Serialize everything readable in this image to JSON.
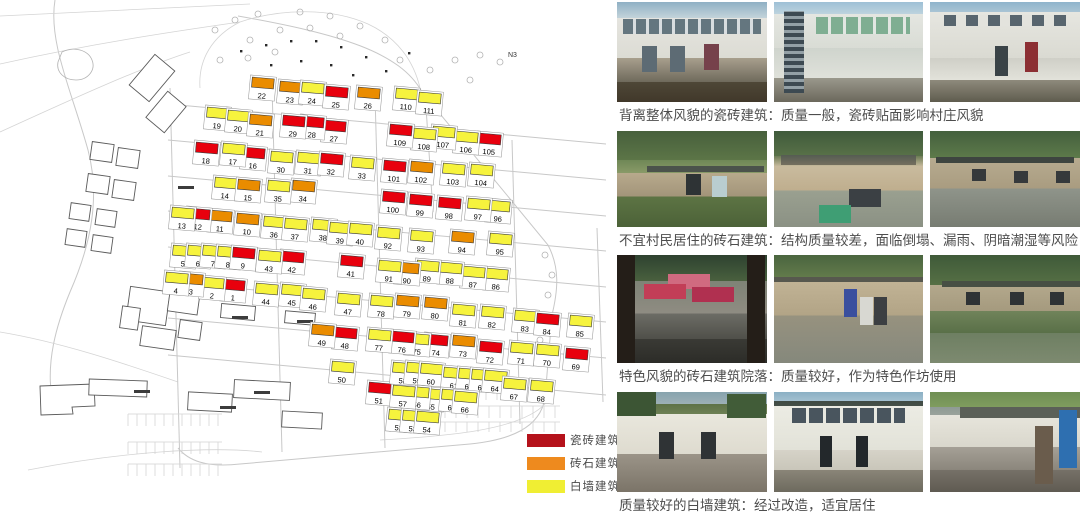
{
  "map": {
    "area_label": "N3",
    "building_colors": {
      "R": "#e8000d",
      "O": "#ea8c00",
      "Y": "#f6f33d"
    },
    "buildings": [
      [
        1,
        233,
        295,
        "R"
      ],
      [
        2,
        212,
        293,
        "Y"
      ],
      [
        3,
        191,
        289,
        "O"
      ],
      [
        4,
        176,
        288,
        "Y"
      ],
      [
        5,
        183,
        261,
        "Y"
      ],
      [
        6,
        198,
        261,
        "Y"
      ],
      [
        7,
        213,
        261,
        "Y"
      ],
      [
        8,
        228,
        262,
        "Y"
      ],
      [
        9,
        243,
        263,
        "R"
      ],
      [
        10,
        247,
        229,
        "O"
      ],
      [
        11,
        220,
        226,
        "O"
      ],
      [
        12,
        198,
        224,
        "R"
      ],
      [
        13,
        182,
        223,
        "Y"
      ],
      [
        14,
        225,
        193,
        "Y"
      ],
      [
        15,
        248,
        195,
        "O"
      ],
      [
        16,
        253,
        163,
        "R"
      ],
      [
        17,
        233,
        159,
        "Y"
      ],
      [
        18,
        206,
        158,
        "R"
      ],
      [
        19,
        217,
        123,
        "Y"
      ],
      [
        20,
        238,
        126,
        "Y"
      ],
      [
        21,
        260,
        130,
        "O"
      ],
      [
        22,
        262,
        93,
        "O"
      ],
      [
        23,
        290,
        97,
        "O"
      ],
      [
        24,
        312,
        98,
        "Y"
      ],
      [
        25,
        336,
        102,
        "R"
      ],
      [
        26,
        368,
        103,
        "O"
      ],
      [
        27,
        334,
        136,
        "R"
      ],
      [
        28,
        312,
        132,
        "R"
      ],
      [
        29,
        293,
        131,
        "R"
      ],
      [
        30,
        281,
        167,
        "Y"
      ],
      [
        31,
        308,
        168,
        "Y"
      ],
      [
        32,
        331,
        169,
        "R"
      ],
      [
        33,
        362,
        173,
        "Y"
      ],
      [
        34,
        303,
        196,
        "O"
      ],
      [
        35,
        278,
        196,
        "Y"
      ],
      [
        36,
        274,
        232,
        "Y"
      ],
      [
        37,
        295,
        234,
        "Y"
      ],
      [
        38,
        323,
        235,
        "Y"
      ],
      [
        39,
        340,
        238,
        "Y"
      ],
      [
        40,
        360,
        239,
        "Y"
      ],
      [
        41,
        351,
        271,
        "R"
      ],
      [
        42,
        292,
        267,
        "R"
      ],
      [
        43,
        269,
        266,
        "Y"
      ],
      [
        44,
        266,
        299,
        "Y"
      ],
      [
        45,
        292,
        300,
        "Y"
      ],
      [
        46,
        313,
        304,
        "Y"
      ],
      [
        47,
        348,
        309,
        "Y"
      ],
      [
        48,
        345,
        343,
        "R"
      ],
      [
        49,
        322,
        340,
        "O"
      ],
      [
        50,
        342,
        377,
        "Y"
      ],
      [
        51,
        379,
        398,
        "R"
      ],
      [
        52,
        399,
        425,
        "Y"
      ],
      [
        53,
        413,
        426,
        "Y"
      ],
      [
        54,
        427,
        427,
        "Y"
      ],
      [
        55,
        431,
        404,
        "Y"
      ],
      [
        56,
        417,
        402,
        "Y"
      ],
      [
        57,
        403,
        401,
        "Y"
      ],
      [
        58,
        403,
        378,
        "Y"
      ],
      [
        59,
        417,
        378,
        "Y"
      ],
      [
        60,
        431,
        379,
        "Y"
      ],
      [
        61,
        454,
        383,
        "Y"
      ],
      [
        62,
        469,
        384,
        "Y"
      ],
      [
        63,
        482,
        385,
        "Y"
      ],
      [
        64,
        495,
        386,
        "Y"
      ],
      [
        65,
        452,
        405,
        "Y"
      ],
      [
        66,
        465,
        407,
        "Y"
      ],
      [
        67,
        514,
        394,
        "Y"
      ],
      [
        68,
        541,
        396,
        "Y"
      ],
      [
        69,
        576,
        364,
        "R"
      ],
      [
        70,
        547,
        360,
        "Y"
      ],
      [
        71,
        521,
        358,
        "Y"
      ],
      [
        72,
        490,
        357,
        "R"
      ],
      [
        73,
        463,
        351,
        "O"
      ],
      [
        74,
        436,
        350,
        "R"
      ],
      [
        75,
        417,
        349,
        "Y"
      ],
      [
        76,
        402,
        347,
        "R"
      ],
      [
        77,
        379,
        345,
        "Y"
      ],
      [
        78,
        381,
        311,
        "Y"
      ],
      [
        79,
        407,
        311,
        "O"
      ],
      [
        80,
        435,
        313,
        "O"
      ],
      [
        81,
        463,
        320,
        "Y"
      ],
      [
        82,
        492,
        322,
        "Y"
      ],
      [
        83,
        525,
        326,
        "Y"
      ],
      [
        84,
        547,
        329,
        "R"
      ],
      [
        85,
        580,
        331,
        "Y"
      ],
      [
        86,
        496,
        284,
        "Y"
      ],
      [
        87,
        473,
        282,
        "Y"
      ],
      [
        88,
        450,
        278,
        "Y"
      ],
      [
        89,
        427,
        276,
        "Y"
      ],
      [
        90,
        407,
        278,
        "O"
      ],
      [
        91,
        389,
        276,
        "Y"
      ],
      [
        92,
        388,
        243,
        "Y"
      ],
      [
        93,
        421,
        246,
        "Y"
      ],
      [
        94,
        462,
        247,
        "O"
      ],
      [
        95,
        500,
        249,
        "Y"
      ],
      [
        96,
        498,
        216,
        "Y"
      ],
      [
        97,
        478,
        214,
        "Y"
      ],
      [
        98,
        449,
        213,
        "R"
      ],
      [
        99,
        420,
        210,
        "R"
      ],
      [
        100,
        393,
        207,
        "R"
      ],
      [
        101,
        394,
        176,
        "R"
      ],
      [
        102,
        421,
        177,
        "O"
      ],
      [
        103,
        453,
        179,
        "Y"
      ],
      [
        104,
        481,
        180,
        "Y"
      ],
      [
        105,
        489,
        149,
        "R"
      ],
      [
        106,
        466,
        147,
        "Y"
      ],
      [
        107,
        443,
        142,
        "Y"
      ],
      [
        108,
        424,
        144,
        "Y"
      ],
      [
        109,
        400,
        140,
        "R"
      ],
      [
        110,
        406,
        104,
        "Y"
      ],
      [
        111,
        429,
        108,
        "Y"
      ]
    ]
  },
  "legend": {
    "items": [
      {
        "label": "瓷砖建筑",
        "color": "#b5121b"
      },
      {
        "label": "砖石建筑",
        "color": "#ee8a1e"
      },
      {
        "label": "白墙建筑",
        "color": "#f0ee33"
      }
    ]
  },
  "photo_rows": [
    {
      "caption": "背离整体风貌的瓷砖建筑：质量一般，瓷砖贴面影响村庄风貌",
      "photos": [
        "tile-house-1",
        "tile-house-2",
        "tile-house-3"
      ]
    },
    {
      "caption": "不宜村民居住的砖石建筑：结构质量较差，面临倒塌、漏雨、阴暗潮湿等风险",
      "photos": [
        "stone-house-1",
        "stone-house-2",
        "stone-house-3"
      ]
    },
    {
      "caption": "特色风貌的砖石建筑院落：质量较好，作为特色作坊使用",
      "photos": [
        "courtyard-1",
        "courtyard-2",
        "courtyard-3"
      ]
    },
    {
      "caption": "质量较好的白墙建筑：经过改造，适宜居住",
      "photos": [
        "white-house-1",
        "white-house-2",
        "white-house-3"
      ]
    }
  ]
}
